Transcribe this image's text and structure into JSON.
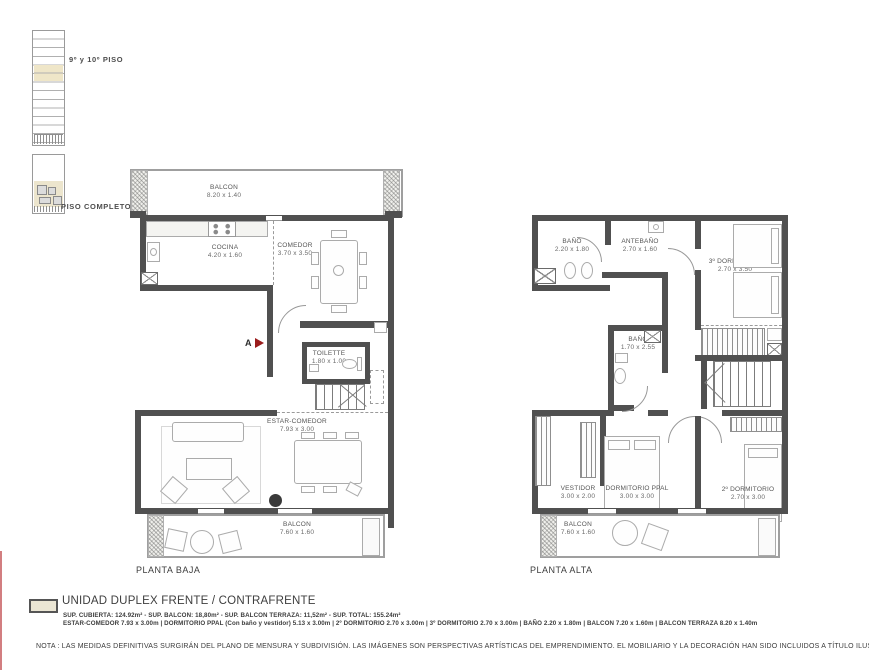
{
  "key": {
    "upper_label": "9º y 10º PISO",
    "lower_label": "PISO COMPLETO"
  },
  "plans": {
    "baja": {
      "title": "PLANTA BAJA",
      "marker": "A",
      "rooms": {
        "balcon_top": {
          "name": "BALCON",
          "dims": "8.20 x 1.40"
        },
        "cocina": {
          "name": "COCINA",
          "dims": "4.20 x 1.60"
        },
        "comedor": {
          "name": "COMEDOR",
          "dims": "3.70 x 3.50"
        },
        "toilette": {
          "name": "TOILETTE",
          "dims": "1.80 x 1.00"
        },
        "estar": {
          "name": "ESTAR-COMEDOR",
          "dims": "7.93 x 3.00"
        },
        "balcon_bottom": {
          "name": "BALCON",
          "dims": "7.60 x 1.60"
        }
      }
    },
    "alta": {
      "title": "PLANTA ALTA",
      "rooms": {
        "bano1": {
          "name": "BAÑO",
          "dims": "2.20 x 1.80"
        },
        "antebano": {
          "name": "ANTEBAÑO",
          "dims": "2.70 x 1.60"
        },
        "dorm3": {
          "name": "3º DORMITORIO",
          "dims": "2.70 x 3.50"
        },
        "bano2": {
          "name": "BAÑO",
          "dims": "1.70 x 2.55"
        },
        "vestidor": {
          "name": "VESTIDOR",
          "dims": "3.00 x 2.00"
        },
        "dormppal": {
          "name": "DORMITORIO PPAL",
          "dims": "3.00 x 3.00"
        },
        "dorm2": {
          "name": "2º DORMITORIO",
          "dims": "2.70 x 3.00"
        },
        "balcon": {
          "name": "BALCON",
          "dims": "7.60 x 1.60"
        }
      }
    }
  },
  "legend": {
    "title": "UNIDAD DUPLEX FRENTE / CONTRAFRENTE",
    "line_surfaces": "SUP. CUBIERTA: 124.92m² - SUP. BALCON: 18,80m² - SUP. BALCON TERRAZA: 11,52m² - SUP. TOTAL: 155.24m²",
    "line_rooms": "ESTAR-COMEDOR 7.93 x 3.00m | DORMITORIO PPAL (Con baño y vestidor) 5.13 x 3.00m | 2º DORMITORIO  2.70 x 3.00m | 3º DORMITORIO  2.70 x 3.00m | BAÑO 2.20 x 1.80m | BALCON 7.20 x 1.60m | BALCON TERRAZA 8.20 x 1.40m"
  },
  "note": "NOTA : LAS  MEDIDAS DEFINITIVAS SURGIRÁN DEL PLANO DE MENSURA Y SUBDIVISIÓN. LAS IMÁGENES SON PERSPECTIVAS ARTÍSTICAS DEL EMPRENDIMIENTO. EL MOBILIARIO Y LA DECORACIÓN HAN SIDO INCLUIDOS A TÍTULO ILUSTRATIVO Y NO CONTRACTUAL.",
  "colors": {
    "wall": "#505050",
    "accent_red": "#9b1c1c",
    "beige": "#ece5cd",
    "edge_line": "#d27e80"
  }
}
